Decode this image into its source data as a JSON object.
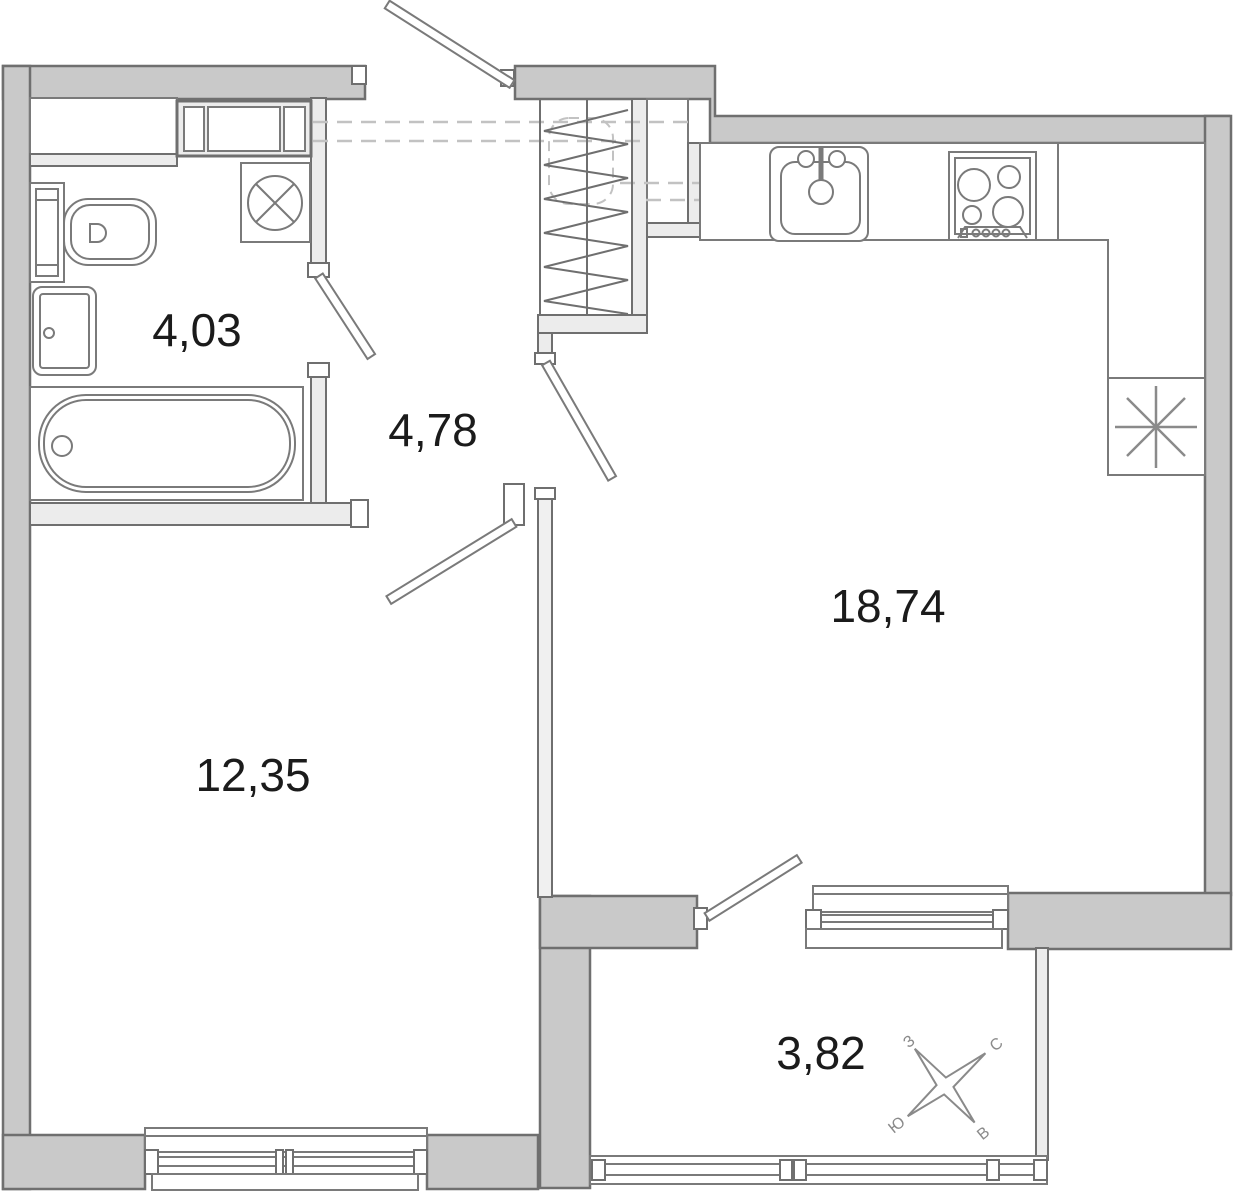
{
  "rooms": [
    {
      "name": "bathroom",
      "area": "4,03"
    },
    {
      "name": "hallway",
      "area": "4,78"
    },
    {
      "name": "kitchen-living-room",
      "area": "18,74"
    },
    {
      "name": "room",
      "area": "12,35"
    },
    {
      "name": "balcony",
      "area": "3,82"
    }
  ],
  "compass": {
    "north": "С",
    "south": "Ю",
    "west": "З",
    "east": "В"
  },
  "colors": {
    "wall": "#c9c9c9",
    "partition": "#ececec",
    "outline": "#6f6f6f",
    "fixture_stroke": "#7a7a7a",
    "dashed_overhead": "#c2c2c2",
    "label_text": "#1b1b1b",
    "compass": "#8a8a8a",
    "background": "#ffffff"
  }
}
